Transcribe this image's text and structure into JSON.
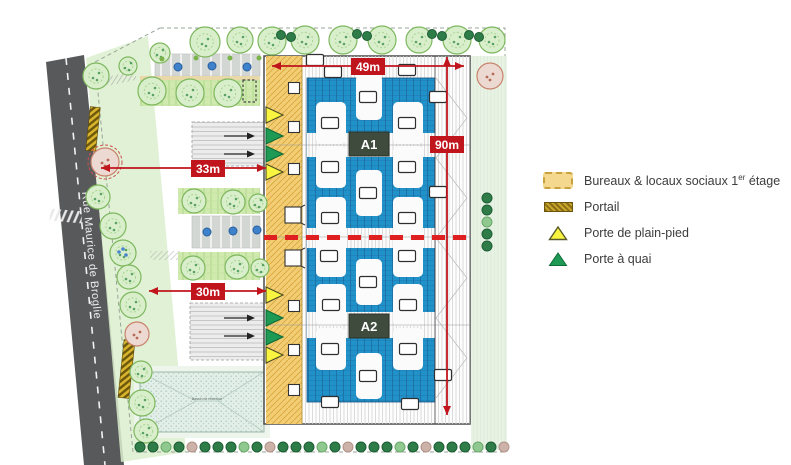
{
  "legend": {
    "items": [
      {
        "prefix": "Bureaux & locaux sociaux 1",
        "sup": "er",
        "suffix": " étage"
      },
      {
        "label": "Portail"
      },
      {
        "label": "Porte de plain-pied"
      },
      {
        "label": "Porte à quai"
      }
    ]
  },
  "plan": {
    "road_name": "Rue Maurice de Broglie",
    "building_labels": {
      "a1": "A1",
      "a2": "A2"
    },
    "dimensions": {
      "top": "49m",
      "right": "90m",
      "mid_left": "33m",
      "lower_left": "30m"
    },
    "basin_label": "Bassin de rétention",
    "colors": {
      "dimension_red": "#c01a1a",
      "dashed_line_red": "#df2020",
      "roof_blue": "#2191c9",
      "bureaux_yellow": "#f2cd74",
      "door_yellow": "#f8f440",
      "door_green": "#1e9a55",
      "building_label_bg": "#3f4b3d",
      "road_gray": "#58595b",
      "tree_green": "#d9efcc"
    },
    "skylights": [
      [
        315,
        60
      ],
      [
        333,
        72
      ],
      [
        407,
        70
      ],
      [
        368,
        97
      ],
      [
        438,
        97
      ],
      [
        330,
        123
      ],
      [
        407,
        123
      ],
      [
        330,
        167
      ],
      [
        407,
        167
      ],
      [
        368,
        193
      ],
      [
        438,
        192
      ],
      [
        330,
        218
      ],
      [
        407,
        218
      ],
      [
        329,
        256
      ],
      [
        407,
        256
      ],
      [
        368,
        282
      ],
      [
        331,
        305
      ],
      [
        408,
        305
      ],
      [
        330,
        349
      ],
      [
        408,
        349
      ],
      [
        368,
        376
      ],
      [
        443,
        375
      ],
      [
        330,
        402
      ],
      [
        410,
        404
      ]
    ],
    "roof_patches": {
      "colA_x": 331,
      "colB_x": 408,
      "rows": [
        123,
        167,
        218,
        256,
        305,
        349
      ],
      "center_x": 369,
      "center_rows": [
        97,
        193,
        282,
        376
      ]
    },
    "doors": [
      {
        "x": 266,
        "y": 115,
        "c": "y"
      },
      {
        "x": 266,
        "y": 136,
        "c": "g"
      },
      {
        "x": 266,
        "y": 154,
        "c": "g"
      },
      {
        "x": 266,
        "y": 172,
        "c": "y"
      },
      {
        "x": 266,
        "y": 295,
        "c": "y"
      },
      {
        "x": 266,
        "y": 318,
        "c": "g"
      },
      {
        "x": 266,
        "y": 337,
        "c": "g"
      },
      {
        "x": 266,
        "y": 355,
        "c": "y"
      }
    ],
    "strip_squares_small": [
      [
        294,
        88
      ],
      [
        294,
        127
      ],
      [
        294,
        169
      ],
      [
        294,
        306
      ],
      [
        294,
        350
      ],
      [
        294,
        390
      ]
    ],
    "strip_squares_big": [
      [
        293,
        215
      ],
      [
        293,
        258
      ]
    ],
    "apron_arrows": [
      [
        224,
        136
      ],
      [
        224,
        154
      ],
      [
        224,
        318
      ],
      [
        224,
        336
      ]
    ],
    "trees": [
      [
        96,
        76,
        13,
        "g"
      ],
      [
        105,
        162,
        14,
        "pr"
      ],
      [
        98,
        197,
        12,
        "g"
      ],
      [
        113,
        226,
        13,
        "g"
      ],
      [
        123,
        253,
        13,
        "gb"
      ],
      [
        129,
        277,
        12,
        "g"
      ],
      [
        133,
        305,
        13,
        "g"
      ],
      [
        137,
        334,
        12,
        "p"
      ],
      [
        141,
        372,
        11,
        "g"
      ],
      [
        142,
        403,
        13,
        "g"
      ],
      [
        146,
        431,
        12,
        "g"
      ],
      [
        160,
        53,
        10,
        "g"
      ],
      [
        128,
        66,
        9,
        "g"
      ],
      [
        205,
        42,
        15,
        "g"
      ],
      [
        240,
        40,
        13,
        "g"
      ],
      [
        272,
        41,
        14,
        "g"
      ],
      [
        305,
        40,
        14,
        "g"
      ],
      [
        343,
        40,
        14,
        "g"
      ],
      [
        382,
        40,
        14,
        "g"
      ],
      [
        419,
        40,
        13,
        "g"
      ],
      [
        457,
        40,
        14,
        "g"
      ],
      [
        492,
        40,
        13,
        "g"
      ],
      [
        152,
        91,
        14,
        "g"
      ],
      [
        190,
        93,
        14,
        "g"
      ],
      [
        228,
        93,
        14,
        "g"
      ],
      [
        194,
        201,
        12,
        "g"
      ],
      [
        233,
        202,
        12,
        "g"
      ],
      [
        258,
        203,
        9,
        "g"
      ],
      [
        193,
        268,
        12,
        "g"
      ],
      [
        237,
        267,
        12,
        "g"
      ],
      [
        260,
        268,
        9,
        "g"
      ],
      [
        490,
        76,
        13,
        "p"
      ]
    ],
    "top_bush_pairs": [
      [
        281,
        35
      ],
      [
        291,
        37
      ],
      [
        357,
        34
      ],
      [
        367,
        36
      ],
      [
        432,
        34
      ],
      [
        442,
        36
      ],
      [
        469,
        35
      ],
      [
        479,
        37
      ]
    ],
    "right_column_bushes": [
      [
        487,
        198,
        "d"
      ],
      [
        487,
        210,
        "d"
      ],
      [
        487,
        222,
        "l"
      ],
      [
        487,
        234,
        "d"
      ],
      [
        487,
        246,
        "d"
      ]
    ],
    "bottom_hedge": {
      "x_start": 140,
      "x_end": 505,
      "step": 13,
      "y": 447,
      "pattern": [
        "d",
        "d",
        "l",
        "d",
        "k",
        "d"
      ]
    },
    "car_dots": [
      [
        178,
        67
      ],
      [
        212,
        66
      ],
      [
        247,
        67
      ],
      [
        207,
        232
      ],
      [
        233,
        231
      ],
      [
        257,
        230
      ]
    ],
    "green_dots": [
      [
        162,
        59
      ],
      [
        196,
        58
      ],
      [
        230,
        58
      ],
      [
        259,
        58
      ]
    ]
  }
}
